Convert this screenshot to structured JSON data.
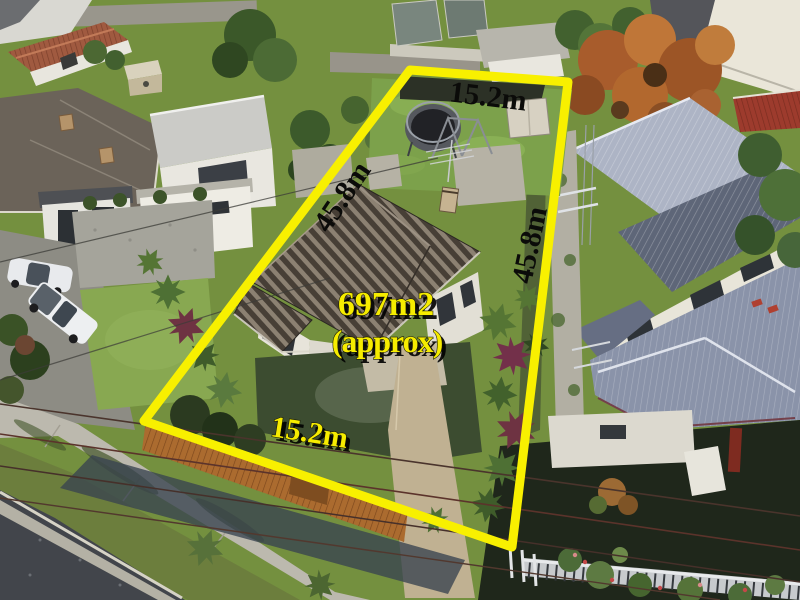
{
  "image": {
    "type": "aerial real-estate photograph",
    "description": "Aerial view of a suburban house lot outlined in yellow with measurements"
  },
  "annotation": {
    "colors": {
      "boundary": "#f8f000",
      "label_dark": "#0b0b09",
      "label_yellow": "#f6ec00"
    },
    "labels": {
      "top_width": "15.2m",
      "left_depth": "45.8m",
      "right_depth": "45.8m",
      "area": "697m2",
      "area_qualifier": "(approx)",
      "bottom_width": "15.2m"
    }
  }
}
